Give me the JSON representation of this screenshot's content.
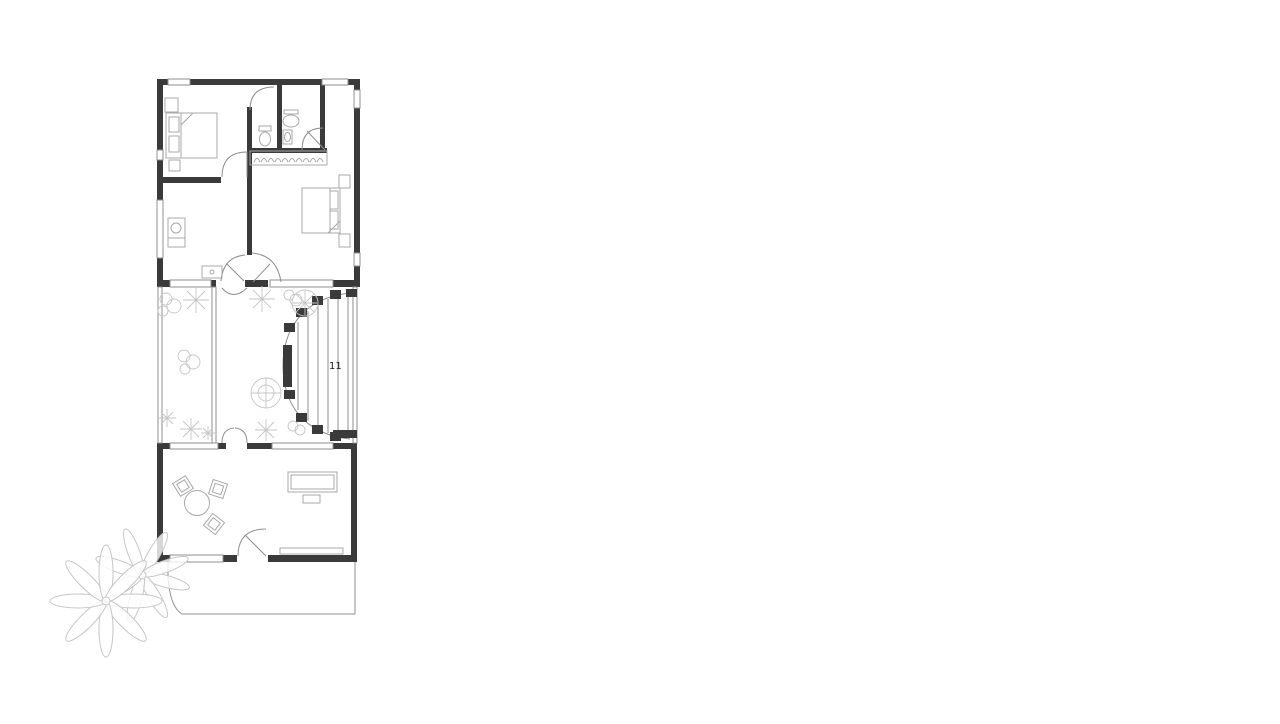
{
  "plan": {
    "stairs_label": "11",
    "colors": {
      "wall": "#3a3a3a",
      "line": "#8f8f8f",
      "furniture": "#a8a8a8",
      "vegetation": "#c6c6c6",
      "background": "#ffffff",
      "label": "#1a1a1a"
    },
    "objects": [
      "double-bed",
      "nightstand",
      "wardrobe-rail",
      "toilet",
      "washbasin",
      "utility-sink",
      "fan-staircase",
      "garden-shrub",
      "grass-tuft",
      "round-tree",
      "dining-table",
      "dining-chair",
      "sofa",
      "coffee-table",
      "tv-console",
      "palm-tree",
      "terrace"
    ]
  }
}
